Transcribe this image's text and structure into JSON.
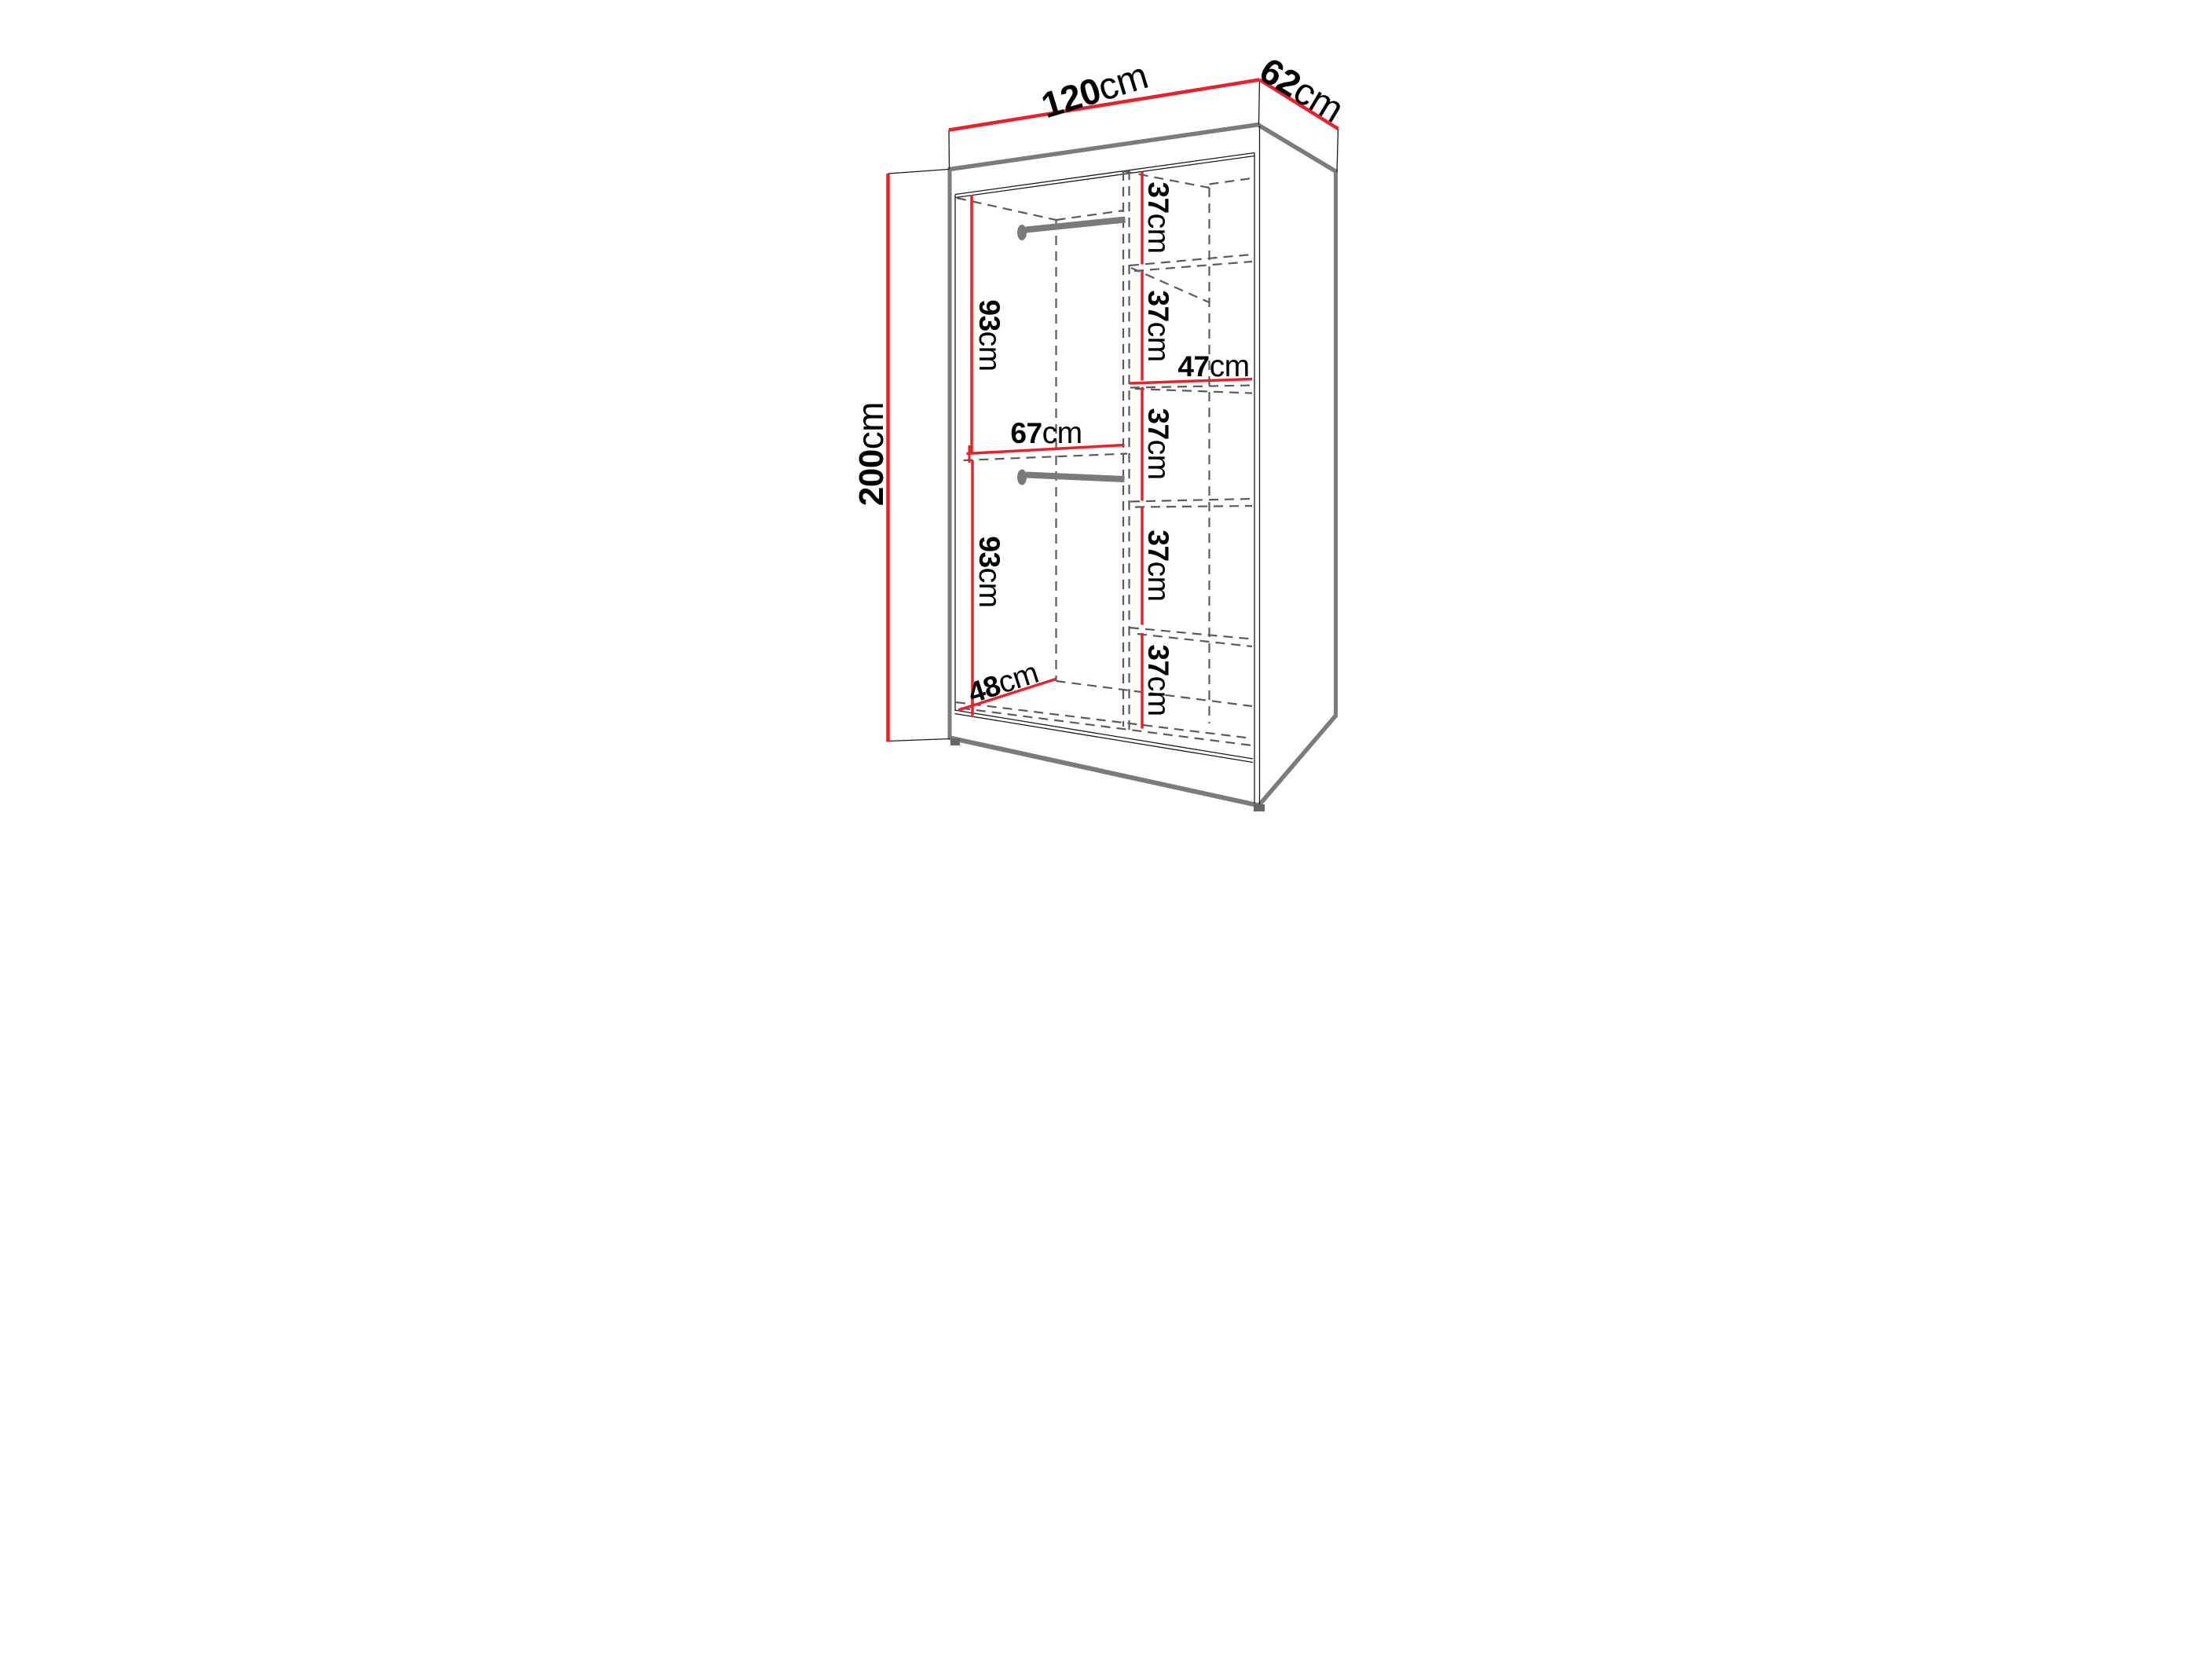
{
  "diagram": {
    "type": "wardrobe-dimension-drawing",
    "unit": "cm",
    "colors": {
      "dimension_red": "#e8212a",
      "edge_gray": "#7b7b7b",
      "dash_gray": "#5a5a5a",
      "line_black": "#1a1a1a",
      "background": "#ffffff"
    },
    "labels": {
      "width": {
        "value": "120",
        "unit": "cm"
      },
      "depth": {
        "value": "62",
        "unit": "cm"
      },
      "height": {
        "value": "200",
        "unit": "cm"
      },
      "hanging_upper": {
        "value": "93",
        "unit": "cm"
      },
      "hanging_lower": {
        "value": "93",
        "unit": "cm"
      },
      "left_width": {
        "value": "67",
        "unit": "cm"
      },
      "left_depth": {
        "value": "48",
        "unit": "cm"
      },
      "shelf_width": {
        "value": "47",
        "unit": "cm"
      },
      "shelf1": {
        "value": "37",
        "unit": "cm"
      },
      "shelf2": {
        "value": "37",
        "unit": "cm"
      },
      "shelf3": {
        "value": "37",
        "unit": "cm"
      },
      "shelf4": {
        "value": "37",
        "unit": "cm"
      },
      "shelf5": {
        "value": "37",
        "unit": "cm"
      }
    },
    "features": [
      "two hanging rails",
      "five shelf compartments",
      "open front perspective view",
      "hidden edges shown dashed"
    ]
  }
}
